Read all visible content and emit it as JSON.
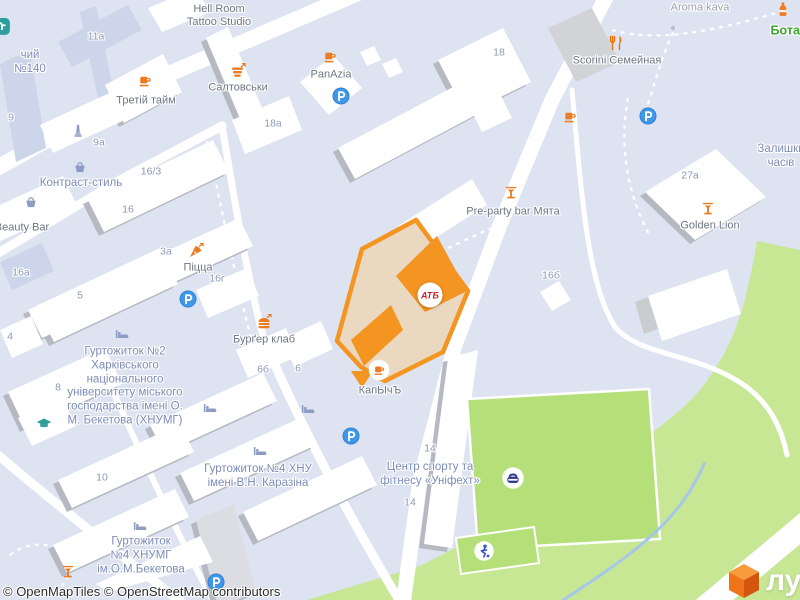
{
  "attribution": {
    "text": "© OpenMapTiles © OpenStreetMap contributors"
  },
  "brand": {
    "logo_text": "лун"
  },
  "highlight": {
    "badge": "АТБ",
    "outline_color": "#f49421",
    "fill_color": "#ead9c0"
  },
  "colors": {
    "background": "#dde3f0",
    "road": "#ffffff",
    "forest": "#c7e795",
    "pitch": "#b4df79",
    "poi_orange": "#ed7b23",
    "parking_blue": "#3e97e9",
    "place_text": "#7c8cb8",
    "poi_text": "#6e7583"
  },
  "map": {
    "labels": [
      {
        "t": "Hell Room\nTattoo Studio",
        "x": 219,
        "y": 16,
        "cls": "poi",
        "name": "poi-label-hell-room-tattoo-studio"
      },
      {
        "t": "Третій тайм",
        "x": 146,
        "y": 101,
        "cls": "poi",
        "name": "poi-label-tretiy-taym"
      },
      {
        "t": "Салтовськи",
        "x": 238,
        "y": 88,
        "cls": "poi",
        "name": "poi-label-saltovsky"
      },
      {
        "t": "PanAzia",
        "x": 331,
        "y": 75,
        "cls": "poi",
        "name": "poi-label-panazia"
      },
      {
        "t": "Scorini Семейная",
        "x": 617,
        "y": 61,
        "cls": "poi",
        "name": "poi-label-scorini"
      },
      {
        "t": "Aroma kava",
        "x": 700,
        "y": 8,
        "cls": "aroma",
        "name": "poi-label-aroma-kava"
      },
      {
        "t": "Pre-party bar Мята",
        "x": 513,
        "y": 212,
        "cls": "poi",
        "name": "poi-label-preparty-bar"
      },
      {
        "t": "Golden Lion",
        "x": 710,
        "y": 226,
        "cls": "poi",
        "name": "poi-label-golden-lion"
      },
      {
        "t": "Піцца",
        "x": 198,
        "y": 268,
        "cls": "poi",
        "name": "poi-label-pizza"
      },
      {
        "t": "Бурґер клаб",
        "x": 264,
        "y": 340,
        "cls": "poi",
        "name": "poi-label-burger-klab"
      },
      {
        "t": "КапЫчЪ",
        "x": 380,
        "y": 391,
        "cls": "poi",
        "name": "poi-label-kapych"
      },
      {
        "t": "Beauty Bar",
        "x": 22,
        "y": 228,
        "cls": "poi",
        "name": "poi-label-beauty-bar"
      },
      {
        "t": "Контраст-стиль",
        "x": 81,
        "y": 184,
        "cls": "place",
        "name": "place-label-kontrast-stil"
      },
      {
        "t": "чий\n№140",
        "x": 30,
        "y": 63,
        "cls": "place",
        "name": "place-label-140"
      },
      {
        "t": "Залишки\nчасів",
        "x": 781,
        "y": 157,
        "cls": "place",
        "name": "place-label-zalyshky-chasiv"
      },
      {
        "t": "Гуртожиток №2\nХарківського\nнаціонального\nуніверситету міського\nгосподарства імені О.\nМ. Бекетова (ХНУМГ)",
        "x": 125,
        "y": 387,
        "cls": "place",
        "name": "place-label-dorm2-khnumg"
      },
      {
        "t": "Гуртожиток №4 ХНУ\nімені В.Н. Каразіна",
        "x": 258,
        "y": 477,
        "cls": "place",
        "name": "place-label-dorm4-khnu"
      },
      {
        "t": "Гуртожиток\n№4 ХНУМГ\nім.О.М.Бекетова",
        "x": 141,
        "y": 556,
        "cls": "place",
        "name": "place-label-dorm4-khnumg"
      },
      {
        "t": "Центр спорту та\nфітнесу «Уніфехт»",
        "x": 430,
        "y": 475,
        "cls": "place",
        "name": "place-label-unifekht"
      },
      {
        "t": "Ботан",
        "x": 789,
        "y": 31,
        "cls": "green",
        "name": "park-label-botanic"
      },
      {
        "t": "11a",
        "x": 96,
        "y": 37,
        "cls": "num",
        "name": "building-number"
      },
      {
        "t": "9a",
        "x": 99,
        "y": 143,
        "cls": "num",
        "name": "building-number"
      },
      {
        "t": "9",
        "x": 11,
        "y": 118,
        "cls": "num",
        "name": "building-number"
      },
      {
        "t": "18a",
        "x": 273,
        "y": 124,
        "cls": "num",
        "name": "building-number"
      },
      {
        "t": "18",
        "x": 499,
        "y": 53,
        "cls": "num",
        "name": "building-number"
      },
      {
        "t": "16/3",
        "x": 151,
        "y": 172,
        "cls": "num",
        "name": "building-number"
      },
      {
        "t": "16",
        "x": 128,
        "y": 210,
        "cls": "num",
        "name": "building-number"
      },
      {
        "t": "16a",
        "x": 21,
        "y": 273,
        "cls": "num",
        "name": "building-number"
      },
      {
        "t": "3a",
        "x": 166,
        "y": 252,
        "cls": "num",
        "name": "building-number"
      },
      {
        "t": "16г",
        "x": 217,
        "y": 279,
        "cls": "num",
        "name": "building-number"
      },
      {
        "t": "5",
        "x": 80,
        "y": 296,
        "cls": "num",
        "name": "building-number"
      },
      {
        "t": "27a",
        "x": 690,
        "y": 176,
        "cls": "num",
        "name": "building-number"
      },
      {
        "t": "16б",
        "x": 551,
        "y": 276,
        "cls": "num",
        "name": "building-number"
      },
      {
        "t": "6б",
        "x": 263,
        "y": 370,
        "cls": "num",
        "name": "building-number"
      },
      {
        "t": "6",
        "x": 298,
        "y": 369,
        "cls": "num",
        "name": "building-number"
      },
      {
        "t": "4",
        "x": 10,
        "y": 337,
        "cls": "num",
        "name": "building-number"
      },
      {
        "t": "8",
        "x": 58,
        "y": 388,
        "cls": "num",
        "name": "building-number"
      },
      {
        "t": "10",
        "x": 102,
        "y": 478,
        "cls": "num",
        "name": "building-number"
      },
      {
        "t": "14",
        "x": 430,
        "y": 449,
        "cls": "num",
        "name": "building-number"
      },
      {
        "t": "14",
        "x": 410,
        "y": 503,
        "cls": "num",
        "name": "building-number"
      }
    ],
    "icons": [
      {
        "type": "cup",
        "x": 145,
        "y": 81
      },
      {
        "type": "cup",
        "x": 330,
        "y": 57
      },
      {
        "type": "cup",
        "x": 570,
        "y": 117
      },
      {
        "type": "cup-circle",
        "x": 379,
        "y": 370
      },
      {
        "type": "shop",
        "x": 238,
        "y": 71
      },
      {
        "type": "restaurant",
        "x": 616,
        "y": 43
      },
      {
        "type": "cocktail",
        "x": 511,
        "y": 192
      },
      {
        "type": "cocktail",
        "x": 708,
        "y": 208
      },
      {
        "type": "cocktail",
        "x": 68,
        "y": 571
      },
      {
        "type": "burger",
        "x": 264,
        "y": 322
      },
      {
        "type": "pizza",
        "x": 196,
        "y": 251
      },
      {
        "type": "bottle",
        "x": 783,
        "y": 9
      },
      {
        "type": "parking",
        "x": 341,
        "y": 96
      },
      {
        "type": "parking",
        "x": 648,
        "y": 116
      },
      {
        "type": "parking",
        "x": 188,
        "y": 299
      },
      {
        "type": "parking",
        "x": 351,
        "y": 436
      },
      {
        "type": "parking",
        "x": 216,
        "y": 582
      },
      {
        "type": "basket",
        "x": 80,
        "y": 167
      },
      {
        "type": "basket",
        "x": 31,
        "y": 202
      },
      {
        "type": "bed",
        "x": 122,
        "y": 334
      },
      {
        "type": "bed",
        "x": 210,
        "y": 408
      },
      {
        "type": "bed",
        "x": 308,
        "y": 409
      },
      {
        "type": "bed",
        "x": 260,
        "y": 451
      },
      {
        "type": "bed",
        "x": 140,
        "y": 526
      },
      {
        "type": "graduation-cap",
        "x": 44,
        "y": 424
      },
      {
        "type": "monument",
        "x": 78,
        "y": 131
      },
      {
        "type": "sports-circle",
        "x": 513,
        "y": 478
      },
      {
        "type": "runner-circle",
        "x": 484,
        "y": 551
      },
      {
        "type": "gate-diamond",
        "x": 673,
        "y": 28
      },
      {
        "type": "school-corner",
        "x": 2,
        "y": 27
      }
    ]
  }
}
